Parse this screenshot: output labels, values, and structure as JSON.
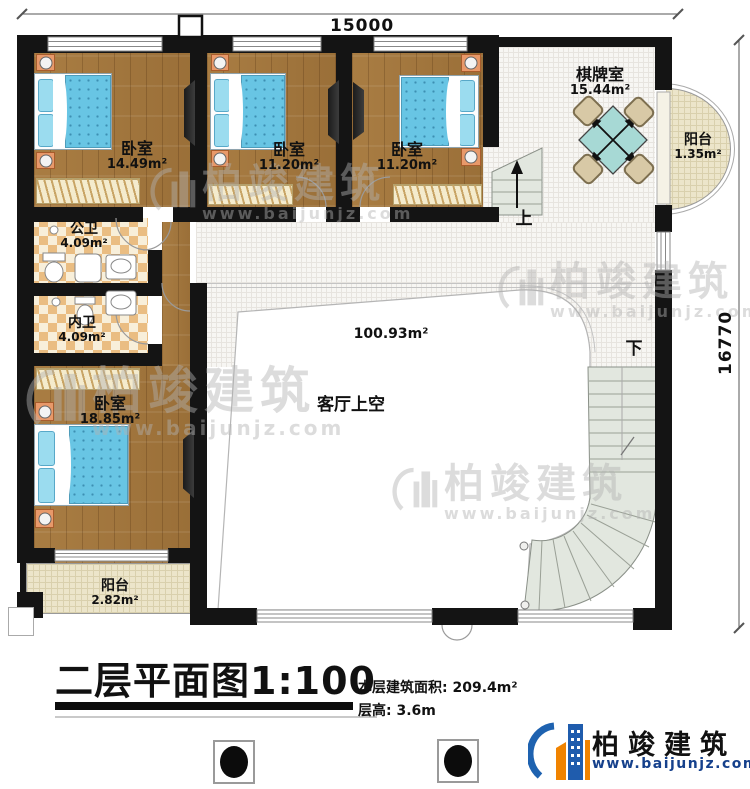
{
  "dims": {
    "width": "15000",
    "height": "16770"
  },
  "rooms": [
    {
      "name": "卧室",
      "area": "14.49m²"
    },
    {
      "name": "卧室",
      "area": "11.20m²"
    },
    {
      "name": "卧室",
      "area": "11.20m²"
    },
    {
      "name": "棋牌室",
      "area": "15.44m²"
    },
    {
      "name": "阳台",
      "area": "1.35m²"
    },
    {
      "name": "公卫",
      "area": "4.09m²"
    },
    {
      "name": "内卫",
      "area": "4.09m²"
    },
    {
      "name": "卧室",
      "area": "18.85m²"
    },
    {
      "name": "阳台",
      "area": "2.82m²"
    },
    {
      "name": "客厅上空",
      "area": "100.93m²"
    }
  ],
  "stairs": {
    "up": "上",
    "down": "下"
  },
  "titleblock": {
    "title": "二层平面图1:100",
    "floor_area": "本层建筑面积: 209.4m²",
    "floor_height": "层高: 3.6m"
  },
  "brand": {
    "name": "柏竣建筑",
    "url": "www.baijunjz.com"
  },
  "watermark": {
    "name": "柏竣建筑",
    "url": "www.baijunjz.com"
  }
}
